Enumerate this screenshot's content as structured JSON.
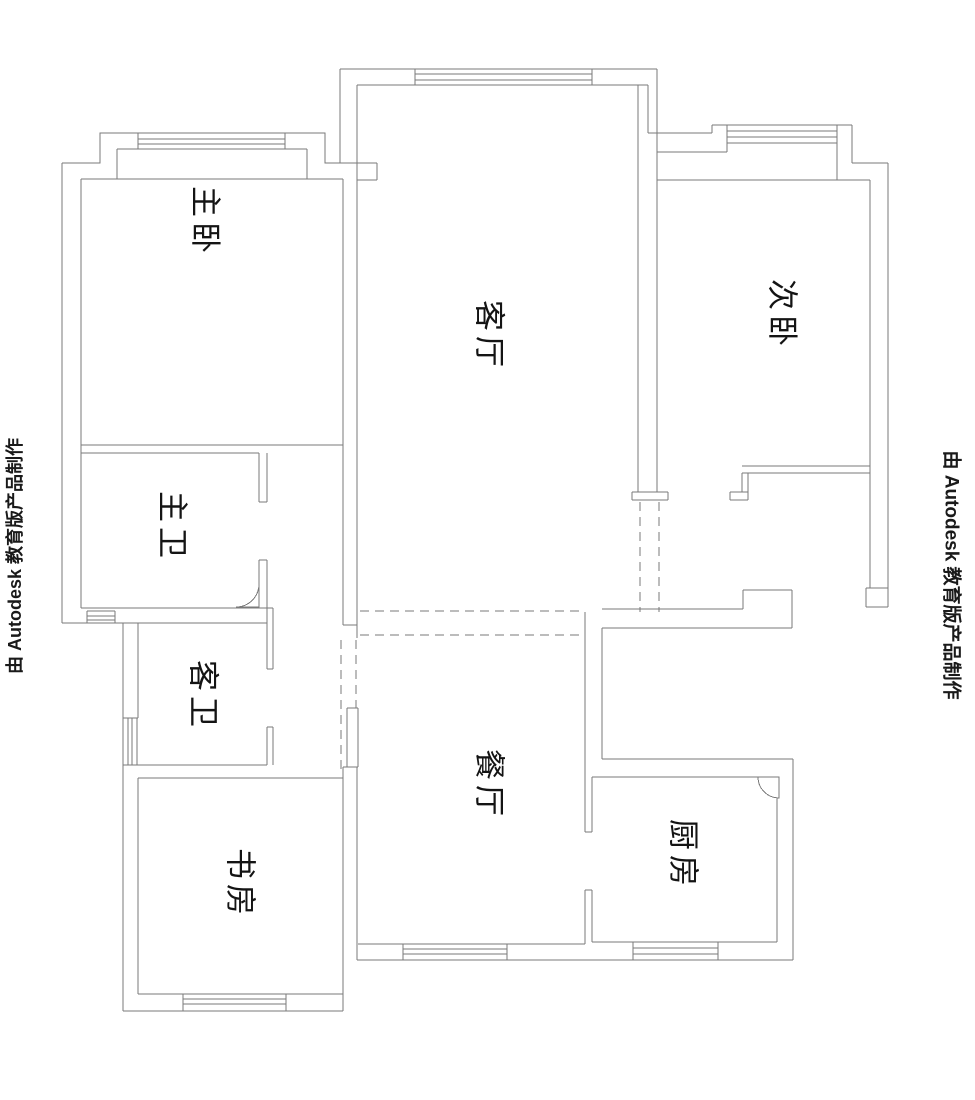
{
  "drawing": {
    "title": "floor-plan",
    "background": "#ffffff",
    "wall_line_color": "#7a7a7a",
    "label_color": "#141414"
  },
  "rooms": [
    {
      "id": "master-bedroom",
      "label": "主卧"
    },
    {
      "id": "second-bedroom",
      "label": "次卧"
    },
    {
      "id": "living-room",
      "label": "客厅"
    },
    {
      "id": "master-bathroom",
      "label": "主卫"
    },
    {
      "id": "guest-bathroom",
      "label": "客卫"
    },
    {
      "id": "study",
      "label": "书房"
    },
    {
      "id": "dining-room",
      "label": "餐厅"
    },
    {
      "id": "kitchen",
      "label": "厨房"
    }
  ],
  "watermarks": {
    "left": "由 Autodesk 教育版产品制作",
    "right": "由 Autodesk 教育版产品制作"
  }
}
